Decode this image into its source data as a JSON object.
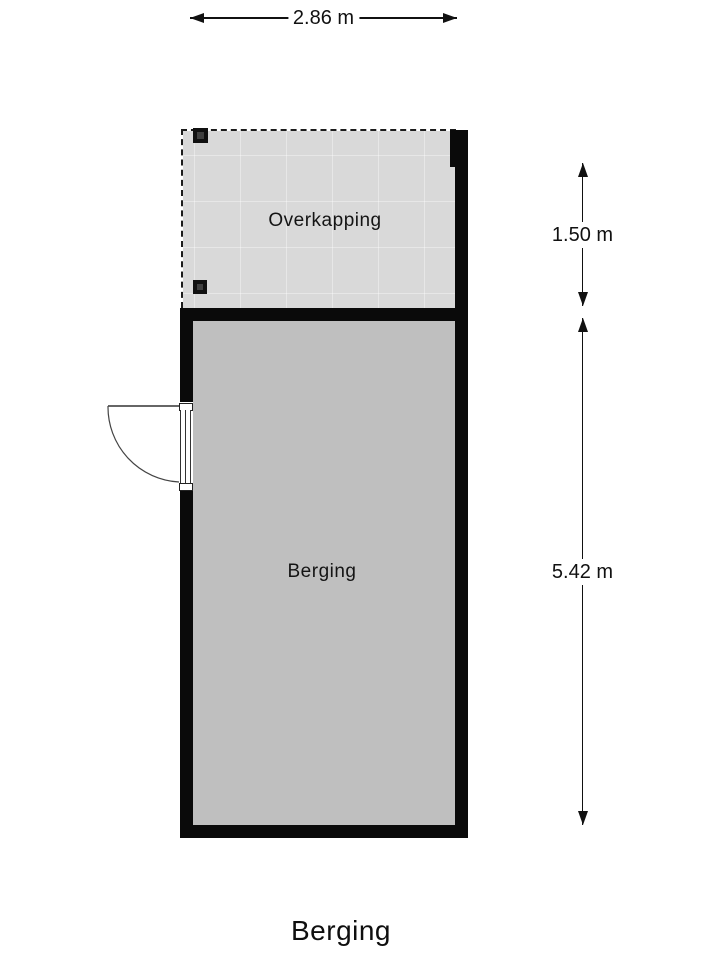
{
  "floorplan": {
    "areas": [
      {
        "label": "Overkapping"
      },
      {
        "label": "Berging"
      }
    ],
    "dimensions": {
      "top_width": "2.86 m",
      "overkapping_depth": "1.50 m",
      "berging_depth": "5.42 m"
    },
    "features": [
      "door-swing-left",
      "dashed-open-boundary",
      "posts"
    ],
    "colors": {
      "background": "#ffffff",
      "overkapping_fill": "#d9d9d9",
      "overkapping_grid_line": "#e9e9e9",
      "berging_fill": "#bfbfbf",
      "wall": "#0a0a0a",
      "dimension_text": "#111111"
    }
  },
  "footer": {
    "title": "Berging"
  }
}
